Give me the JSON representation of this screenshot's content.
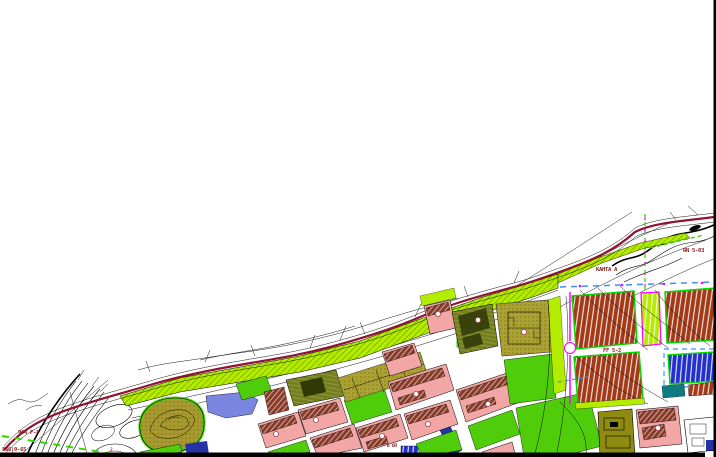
{
  "map": {
    "kind": "urban regulation / zoning plan (CAD export)",
    "labels": [
      {
        "name": "parcel-code-left",
        "text": "904 F-8"
      },
      {
        "name": "parcel-code-corner",
        "text": "866|0-65"
      },
      {
        "name": "zone-code-top-right",
        "text": "RN 5-03"
      },
      {
        "name": "zone-code-right",
        "text": "KAHTA A"
      },
      {
        "name": "zone-code-center-right",
        "text": "FF 5-2"
      },
      {
        "name": "zone-code-bottom-center",
        "text": "Б ОП"
      },
      {
        "name": "stadium-number",
        "text": "2"
      }
    ],
    "features": [
      "terrain-contour-lines",
      "railway-track-bundle",
      "road-interchange-loops",
      "river-greenway-corridor",
      "hill-park-with-contours",
      "water-pond",
      "residential-blocks",
      "building-footprints",
      "sports-fields",
      "hatched-development-parcels",
      "industrial-blocks",
      "stadium-oval",
      "boundary-dashed-lines"
    ],
    "colors": {
      "paper": "#FFFFFF",
      "ink": "#000000",
      "corridor_green": "#B4EC00",
      "park_green": "#4FCC0A",
      "olive_hill": "#A89A2E",
      "khaki_field": "#ACA233",
      "olive_dark": "#75801C",
      "pink_block": "#F2A6A6",
      "building_brown": "#8A3A28",
      "brick_red": "#A23A18",
      "parcel_blue": "#2230CC",
      "water_blue": "#7B86E0",
      "navy": "#2433A6",
      "teal": "#0F7B80",
      "magenta": "#FF00FF",
      "dash_blue": "#3E8EF7",
      "dash_green": "#35D500",
      "line_maroon": "#8F1433",
      "label_red": "#8B1A1A",
      "gray_fill": "#ECECEC",
      "outline_green": "#00D800"
    }
  }
}
